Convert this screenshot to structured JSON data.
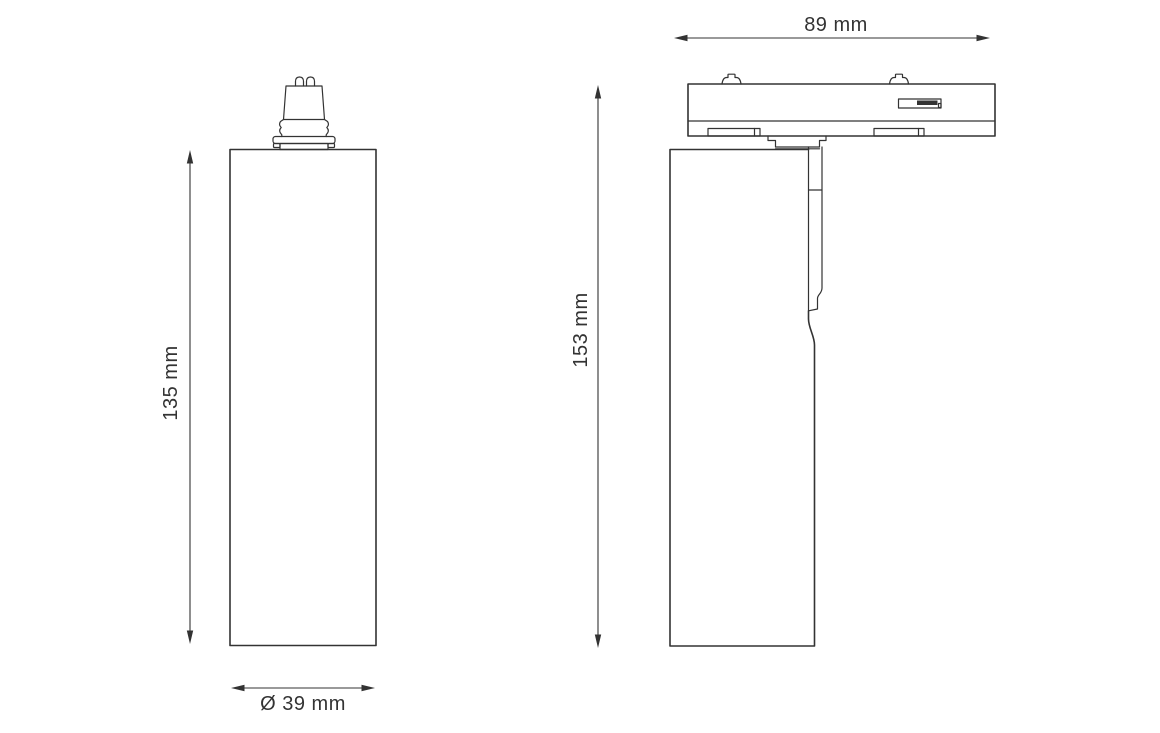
{
  "page": {
    "background": "#ffffff",
    "line_color": "#333333"
  },
  "dimensions": {
    "front_height": "135 mm",
    "front_diameter": "Ø 39 mm",
    "side_depth": "89 mm",
    "side_height": "153 mm"
  }
}
